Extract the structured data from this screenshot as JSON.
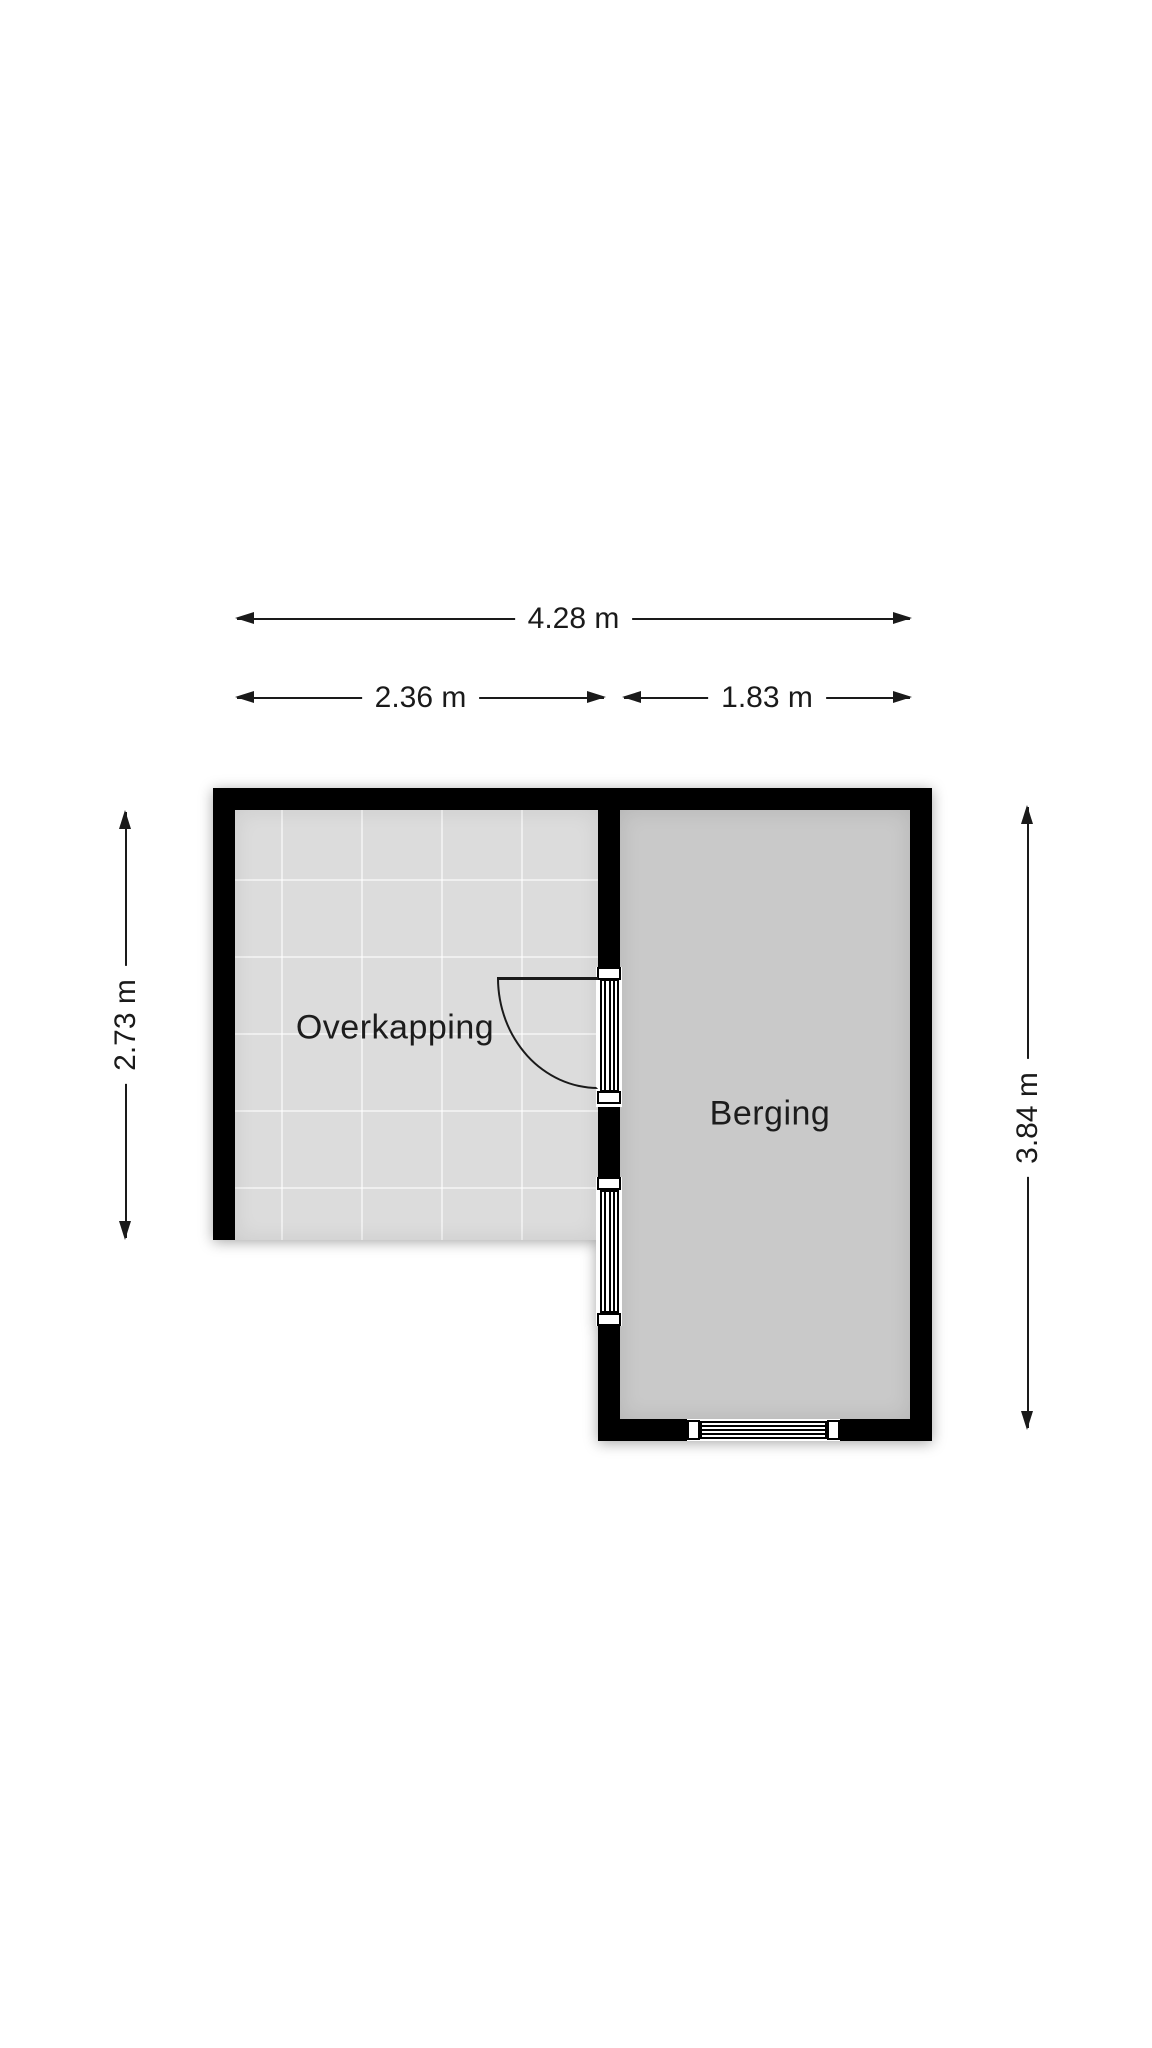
{
  "floorplan": {
    "rooms": [
      {
        "name": "overkapping",
        "label": "Overkapping"
      },
      {
        "name": "berging",
        "label": "Berging"
      }
    ],
    "dimensions": {
      "total_width": "4.28 m",
      "overkapping_width": "2.36 m",
      "berging_width": "1.83 m",
      "overkapping_depth": "2.73 m",
      "berging_depth": "3.84 m"
    },
    "colors": {
      "background": "#ffffff",
      "wall": "#000000",
      "overkapping_floor": "#dcdcdc",
      "tile_joint": "#eaeaea",
      "berging_floor": "#c9c9c9",
      "dimension_text": "#1a1a1a"
    }
  }
}
